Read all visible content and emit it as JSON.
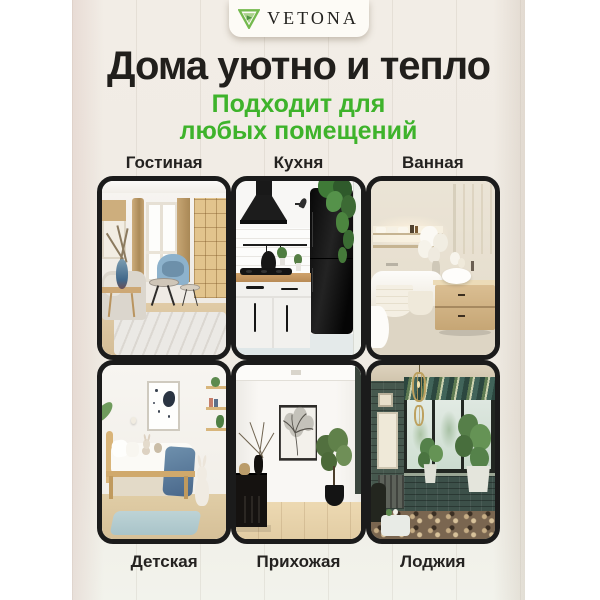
{
  "brand": {
    "name": "VETONA"
  },
  "header": {
    "title": "Дома уютно и тепло",
    "subtitle_lines": [
      "Подходит для",
      "любых помещений"
    ]
  },
  "rooms": [
    {
      "id": "living-room",
      "label": "Гостиная"
    },
    {
      "id": "kitchen",
      "label": "Кухня"
    },
    {
      "id": "bathroom",
      "label": "Ванная"
    },
    {
      "id": "kids-room",
      "label": "Детская"
    },
    {
      "id": "hallway",
      "label": "Прихожая"
    },
    {
      "id": "loggia",
      "label": "Лоджия"
    }
  ],
  "icons": {
    "logo": "vetona-triangle-logo"
  },
  "colors": {
    "accent_green": "#3eb32b",
    "logo_green": "#74b94e",
    "title_black": "#211f1c",
    "card_border": "#1b1b1b",
    "wood_background": "#f0ebe4",
    "badge_background": "#fdfbf6"
  }
}
